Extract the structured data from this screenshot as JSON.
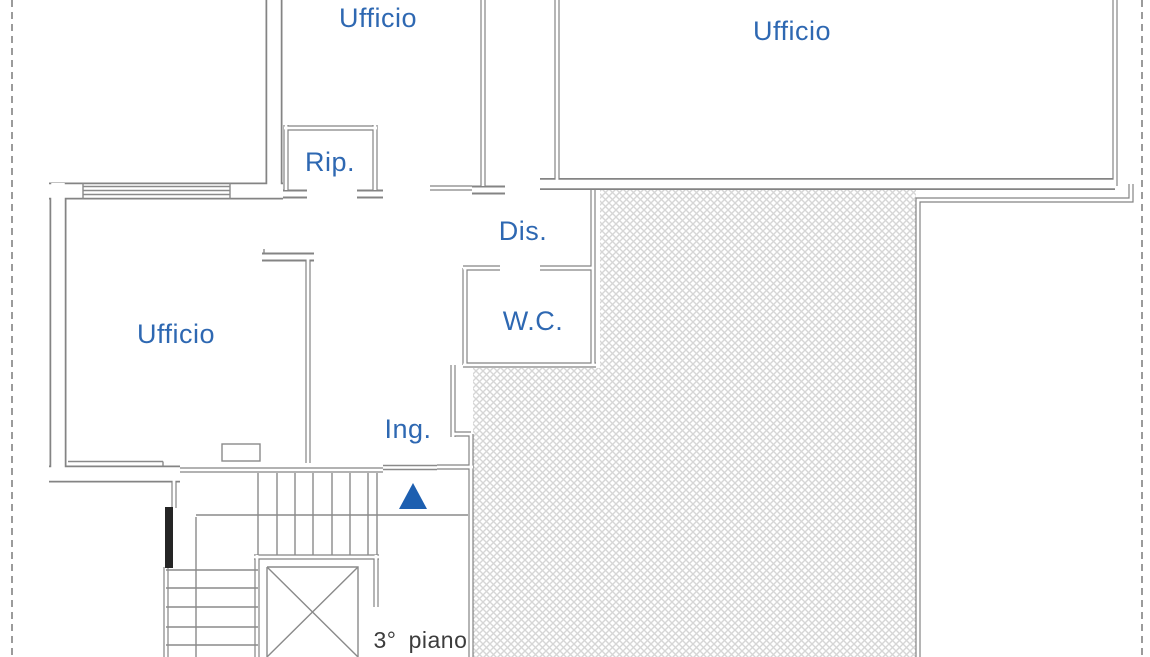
{
  "plan": {
    "rooms": {
      "office_top": "Ufficio",
      "office_right": "Ufficio",
      "office_left": "Ufficio",
      "storage": "Rip.",
      "hallway": "Dis.",
      "wc": "W.C.",
      "entrance": "Ing."
    },
    "floor_label": {
      "number": "3°",
      "word": "piano"
    },
    "icons": {
      "entrance_arrow": "up-triangle"
    },
    "colors": {
      "label_blue": "#2e68b2",
      "wall_gray": "#848484",
      "floor_text": "#3c3c3c",
      "hatch_gray": "#d6d6d6",
      "dashed_border": "#9b9b9b",
      "arrow_blue": "#1d5fb0"
    }
  }
}
